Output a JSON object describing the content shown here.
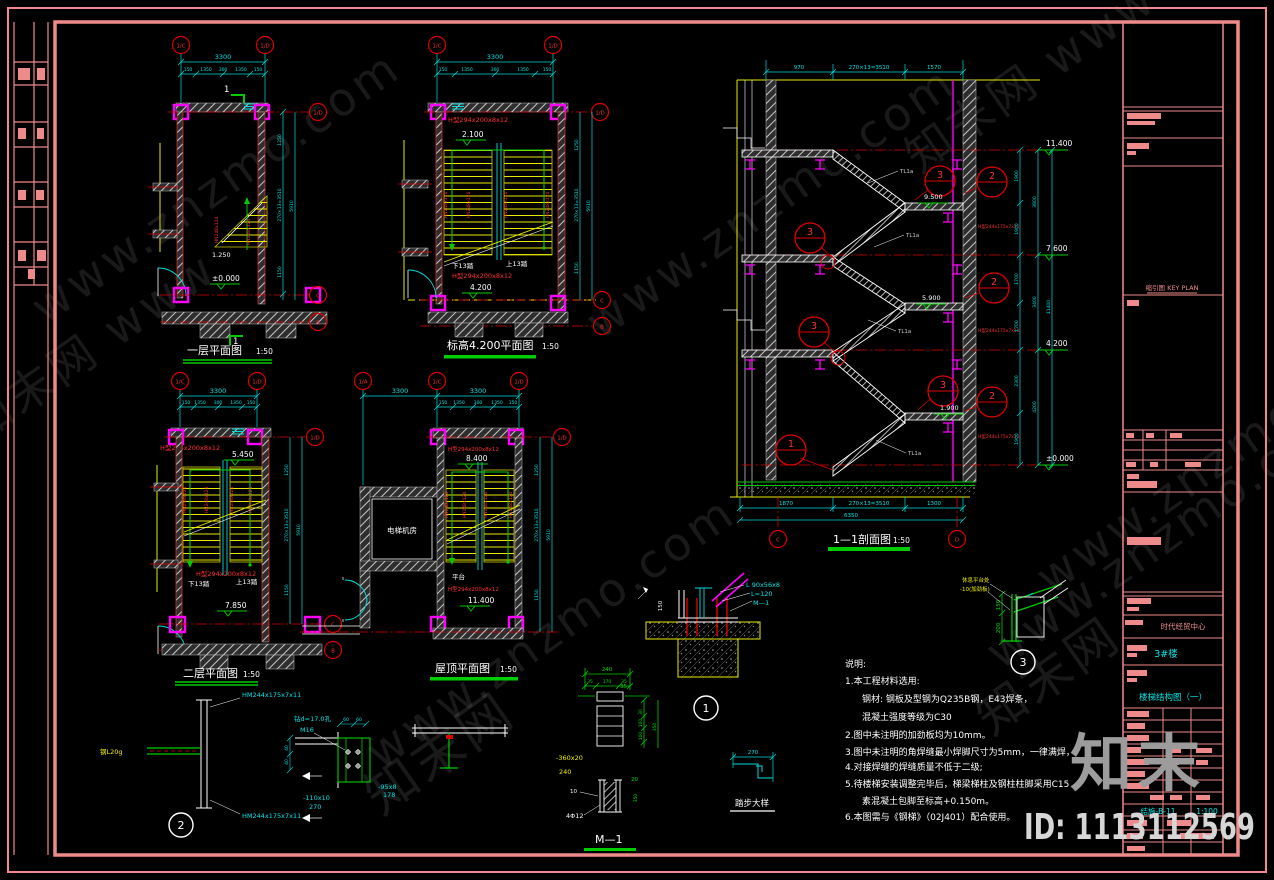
{
  "watermarks": {
    "s1": "www.znzmo.com",
    "s2": "知末网 www",
    "s3": "知末网",
    "logo": "知末",
    "id": "ID: 1113112569"
  },
  "axis": {
    "oneA": "1/A",
    "oneC": "1/C",
    "oneD": "1/D",
    "C": "C",
    "B": "B",
    "D": "D"
  },
  "scale50": "1:50",
  "plans": {
    "p1": {
      "title": "一层平面图",
      "elev0": "±0.000",
      "elev_mid": "1.250",
      "flag": "1"
    },
    "p2": {
      "title": "标高4.200平面图",
      "elev_a": "2.100",
      "elev_b": "4.200"
    },
    "p3": {
      "title": "二层平面图",
      "elev_a": "5.450",
      "elev_b": "7.850"
    },
    "p4": {
      "title": "屋顶平面图",
      "elev_a": "8.400",
      "elev_b": "11.400",
      "room": "电梯机房",
      "platform": "平台"
    }
  },
  "section": {
    "title": "1—1剖面图",
    "e114": "11.400",
    "e76": "7.600",
    "e42": "4.200",
    "e00": "±0.000",
    "e95": "9.500",
    "e59": "5.900",
    "e19": "1.900"
  },
  "dims": {
    "overall": "3300",
    "chain": [
      "150",
      "1350",
      "300",
      "1350",
      "150"
    ],
    "side": [
      "1250",
      "270×13=3510",
      "1150"
    ],
    "side_total": "5910",
    "roof_left": "3300",
    "roof_right": "3300",
    "sec_top": [
      "970",
      "270×13=3510",
      "1570"
    ],
    "sec_bot": [
      "1870",
      "270×13=3510",
      "1300"
    ],
    "sec_bot_total": "6350",
    "sec_r": [
      "1900",
      "1900",
      "1700",
      "1700",
      "2300",
      "1900"
    ],
    "sec_r2": [
      "3800",
      "3400",
      "4200"
    ],
    "sec_r_total": "11400"
  },
  "labels": {
    "beam": "H型294x200x8x12",
    "col": "H型244x175x7x11",
    "stringer": "HN248x124",
    "tl": "TL1a",
    "hm": "HM244x175x7x11",
    "drill": "钻d=17.0孔",
    "bolt": "M16",
    "pl110": "-110x10",
    "n270": "270",
    "pl95": "-95x8",
    "n178": "178",
    "ang": "L 90x56x8",
    "alen": "L=120",
    "m1": "M—1",
    "pl360": "-360x20",
    "n240": "240",
    "n10": "10",
    "reb": "4Φ12",
    "steel": "钢L20g",
    "down": "下13踏",
    "up": "上13踏",
    "det3a": "休息平台处",
    "det3b": "-10(加劲板)",
    "n150": "150",
    "n200": "200",
    "n35": "35",
    "n170": "170",
    "n350": "350",
    "n100": "100",
    "n30": "30",
    "n20": "20",
    "n60": "60",
    "n40": "40",
    "step270": "270"
  },
  "bubbles": {
    "b1": "1",
    "b2": "2",
    "b3": "3"
  },
  "details": {
    "m1_title": "M—1",
    "step_title": "踏步大样"
  },
  "notes": {
    "t": "说明:",
    "l1": "1.本工程材料选用:",
    "l2": "钢材: 钢板及型钢为Q235B钢，E43焊条，",
    "l3": "混凝土强度等级为C30",
    "l4": "2.图中未注明的加劲板均为10mm。",
    "l5": "3.图中未注明的角焊缝最小焊脚尺寸为5mm，一律满焊，",
    "l6": "4.对接焊缝的焊缝质量不低于二级;",
    "l7": "5.待楼梯安装调整完毕后，梯梁梯柱及钢柱柱脚采用C15",
    "l8": "素混凝土包脚至标高+0.150m。",
    "l9": "6.本图需与《钢梯》（02J401）配合使用。"
  },
  "tb": {
    "key": "缩引图 KEY PLAN",
    "project": "时代经贸中心",
    "bld": "3#楼",
    "dwg": "楼梯结构图（一）",
    "no": "结施-B-11",
    "scale": "1:100"
  }
}
